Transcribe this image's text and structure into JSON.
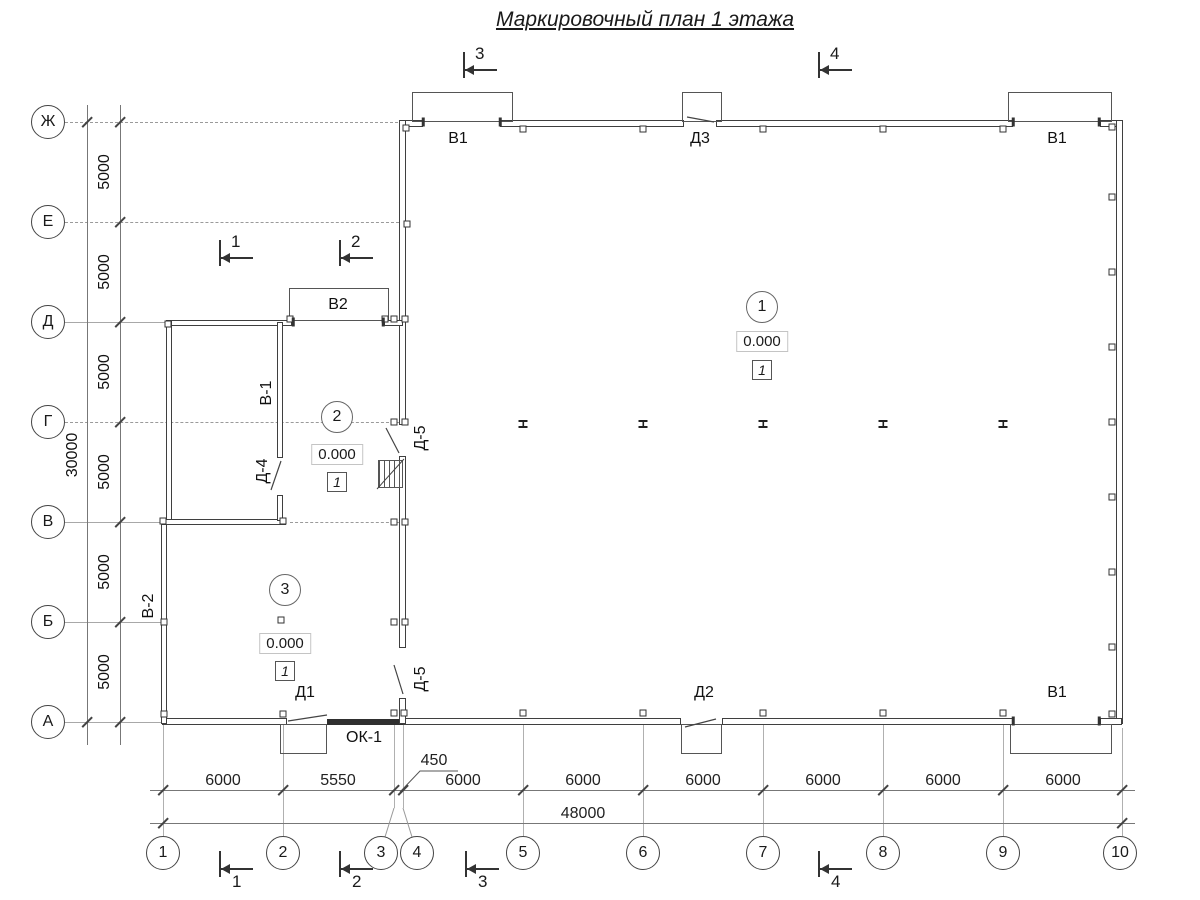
{
  "title": "Маркировочный план 1 этажа",
  "grid": {
    "rows": [
      "Ж",
      "Е",
      "Д",
      "Г",
      "В",
      "Б",
      "А"
    ],
    "cols": [
      "1",
      "2",
      "3",
      "4",
      "5",
      "6",
      "7",
      "8",
      "9",
      "10"
    ]
  },
  "dims": {
    "bottom": [
      "6000",
      "5550",
      "6000",
      "6000",
      "6000",
      "6000",
      "6000",
      "6000"
    ],
    "total": "48000",
    "offset": "450",
    "left": [
      "5000",
      "5000",
      "5000",
      "5000",
      "5000",
      "5000"
    ],
    "left_total": "30000"
  },
  "marks": {
    "v1_top_left": "В1",
    "d3": "Д3",
    "v1_top_right": "В1",
    "v2": "В2",
    "v1_int": "В-1",
    "d4": "Д-4",
    "d5_upper": "Д-5",
    "d5_lower": "Д-5",
    "v2_left": "В-2",
    "d1": "Д1",
    "ok1": "ОК-1",
    "d2": "Д2",
    "v1_bottom_right": "В1"
  },
  "rooms": [
    {
      "number": "1",
      "elevation": "0.000",
      "floor_type": "1"
    },
    {
      "number": "2",
      "elevation": "0.000",
      "floor_type": "1"
    },
    {
      "number": "3",
      "elevation": "0.000",
      "floor_type": "1"
    }
  ],
  "sections": {
    "top": [
      "3",
      "4"
    ],
    "middle": [
      "1",
      "2"
    ],
    "bottom": [
      "1",
      "2",
      "3",
      "4"
    ]
  }
}
